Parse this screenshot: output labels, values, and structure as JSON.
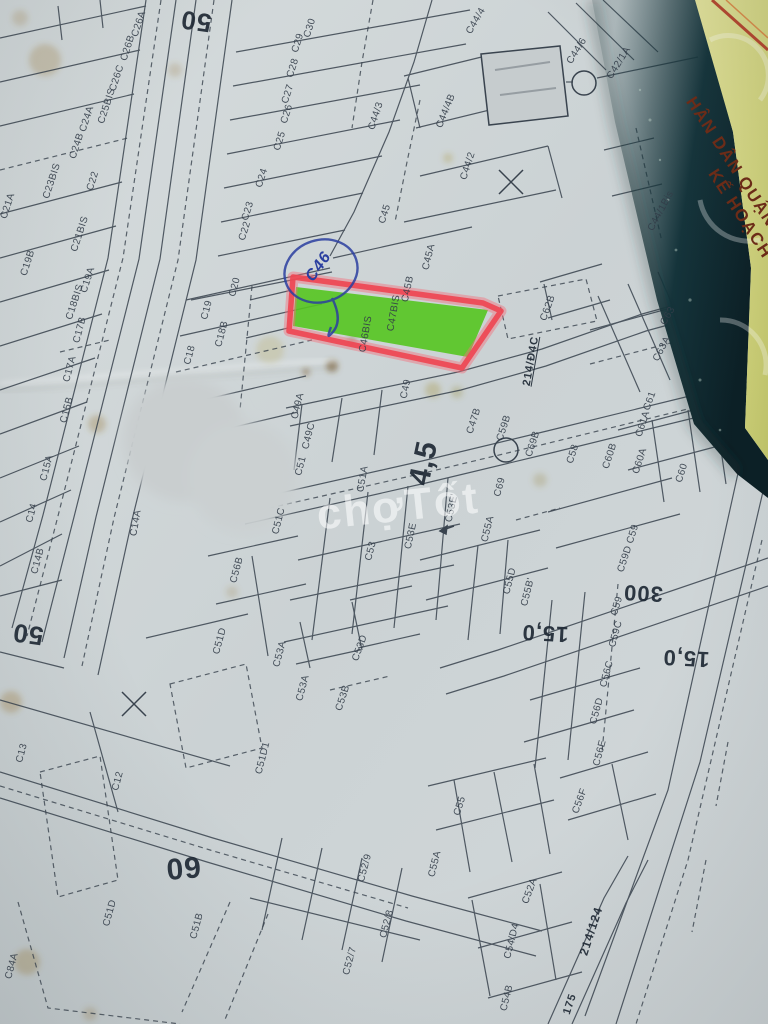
{
  "watermark": {
    "text": "chợTốt"
  },
  "cover_strip": {
    "line1": "HÂN DÂN QUẬN",
    "line2": "KẾ HOẠCH"
  },
  "annotations": {
    "handwritten_parcel": "C46"
  },
  "highlight": {
    "fill": "#55c520",
    "outline": "#ee4752",
    "pen": "#2b3fa0"
  },
  "parcel_labels": [
    {
      "t": "C26A",
      "x": 139,
      "y": 24,
      "r": -72
    },
    {
      "t": "C26B",
      "x": 128,
      "y": 48,
      "r": -72
    },
    {
      "t": "C26C",
      "x": 117,
      "y": 78,
      "r": -72
    },
    {
      "t": "C25BIS",
      "x": 107,
      "y": 106,
      "r": -72
    },
    {
      "t": "C24A",
      "x": 87,
      "y": 119,
      "r": -72
    },
    {
      "t": "C24B",
      "x": 77,
      "y": 146,
      "r": -72
    },
    {
      "t": "C23BIS",
      "x": 52,
      "y": 181,
      "r": -72
    },
    {
      "t": "C22",
      "x": 93,
      "y": 181,
      "r": -72
    },
    {
      "t": "C21A",
      "x": 8,
      "y": 206,
      "r": -72
    },
    {
      "t": "C21BIS",
      "x": 80,
      "y": 234,
      "r": -72
    },
    {
      "t": "C19B",
      "x": 28,
      "y": 263,
      "r": -72
    },
    {
      "t": "C19A",
      "x": 88,
      "y": 280,
      "r": -72
    },
    {
      "t": "C18BIS",
      "x": 75,
      "y": 302,
      "r": -72
    },
    {
      "t": "C17B",
      "x": 80,
      "y": 330,
      "r": -75
    },
    {
      "t": "C17A",
      "x": 70,
      "y": 369,
      "r": -75
    },
    {
      "t": "C15B",
      "x": 67,
      "y": 410,
      "r": -75
    },
    {
      "t": "C15A",
      "x": 47,
      "y": 468,
      "r": -75
    },
    {
      "t": "C14",
      "x": 32,
      "y": 513,
      "r": -75
    },
    {
      "t": "C14B",
      "x": 38,
      "y": 561,
      "r": -75
    },
    {
      "t": "C14A",
      "x": 136,
      "y": 523,
      "r": -80
    },
    {
      "t": "C30",
      "x": 310,
      "y": 28,
      "r": -72
    },
    {
      "t": "C29",
      "x": 298,
      "y": 43,
      "r": -72
    },
    {
      "t": "C28",
      "x": 293,
      "y": 68,
      "r": -72
    },
    {
      "t": "C27",
      "x": 288,
      "y": 94,
      "r": -72
    },
    {
      "t": "C26",
      "x": 287,
      "y": 114,
      "r": -72
    },
    {
      "t": "C25",
      "x": 280,
      "y": 141,
      "r": -72
    },
    {
      "t": "C24",
      "x": 262,
      "y": 178,
      "r": -72
    },
    {
      "t": "C23",
      "x": 248,
      "y": 211,
      "r": -72
    },
    {
      "t": "C22",
      "x": 245,
      "y": 231,
      "r": -72
    },
    {
      "t": "C20",
      "x": 235,
      "y": 287,
      "r": -75
    },
    {
      "t": "C19",
      "x": 207,
      "y": 310,
      "r": -75
    },
    {
      "t": "C18B",
      "x": 222,
      "y": 334,
      "r": -75
    },
    {
      "t": "C18",
      "x": 190,
      "y": 355,
      "r": -75
    },
    {
      "t": "C44/3",
      "x": 376,
      "y": 116,
      "r": -72
    },
    {
      "t": "C44/4",
      "x": 476,
      "y": 21,
      "r": -60
    },
    {
      "t": "C44/4B",
      "x": 446,
      "y": 111,
      "r": -68
    },
    {
      "t": "C44/2",
      "x": 468,
      "y": 166,
      "r": -72
    },
    {
      "t": "C44/6",
      "x": 577,
      "y": 51,
      "r": -58
    },
    {
      "t": "C42/1A",
      "x": 619,
      "y": 63,
      "r": -58
    },
    {
      "t": "C44/1Bis",
      "x": 661,
      "y": 211,
      "r": -62
    },
    {
      "t": "C45",
      "x": 385,
      "y": 214,
      "r": -72
    },
    {
      "t": "C45A",
      "x": 429,
      "y": 257,
      "r": -76
    },
    {
      "t": "C45B",
      "x": 408,
      "y": 289,
      "r": -78
    },
    {
      "t": "C47BIS",
      "x": 394,
      "y": 313,
      "r": -80
    },
    {
      "t": "C46BIS",
      "x": 366,
      "y": 334,
      "r": -80
    },
    {
      "t": "C49",
      "x": 406,
      "y": 389,
      "r": -78
    },
    {
      "t": "C49A",
      "x": 298,
      "y": 406,
      "r": -76
    },
    {
      "t": "C49C",
      "x": 309,
      "y": 436,
      "r": -76
    },
    {
      "t": "C51",
      "x": 301,
      "y": 466,
      "r": -76
    },
    {
      "t": "C51A",
      "x": 363,
      "y": 479,
      "r": -80
    },
    {
      "t": "C51C",
      "x": 279,
      "y": 521,
      "r": -76
    },
    {
      "t": "C47B",
      "x": 474,
      "y": 421,
      "r": -72
    },
    {
      "t": "C62B",
      "x": 548,
      "y": 308,
      "r": -70
    },
    {
      "t": "C63",
      "x": 668,
      "y": 316,
      "r": -60
    },
    {
      "t": "C63A",
      "x": 662,
      "y": 349,
      "r": -62
    },
    {
      "t": "C61",
      "x": 650,
      "y": 401,
      "r": -70
    },
    {
      "t": "C61A",
      "x": 643,
      "y": 424,
      "r": -72
    },
    {
      "t": "C59B",
      "x": 504,
      "y": 428,
      "r": -72
    },
    {
      "t": "C69B",
      "x": 533,
      "y": 444,
      "r": -72
    },
    {
      "t": "C58",
      "x": 573,
      "y": 454,
      "r": -72
    },
    {
      "t": "C60B",
      "x": 610,
      "y": 456,
      "r": -72
    },
    {
      "t": "C60A",
      "x": 640,
      "y": 461,
      "r": -72
    },
    {
      "t": "C60",
      "x": 682,
      "y": 473,
      "r": -72
    },
    {
      "t": "C69",
      "x": 500,
      "y": 487,
      "r": -75
    },
    {
      "t": "C59",
      "x": 633,
      "y": 534,
      "r": -72
    },
    {
      "t": "C59D",
      "x": 625,
      "y": 559,
      "r": -72
    },
    {
      "t": "C59",
      "x": 617,
      "y": 606,
      "r": -72
    },
    {
      "t": "C59C",
      "x": 616,
      "y": 634,
      "r": -75
    },
    {
      "t": "C55D",
      "x": 510,
      "y": 581,
      "r": -76
    },
    {
      "t": "C55B'",
      "x": 528,
      "y": 592,
      "r": -76
    },
    {
      "t": "C53E'",
      "x": 452,
      "y": 508,
      "r": -78
    },
    {
      "t": "C53E",
      "x": 411,
      "y": 536,
      "r": -78
    },
    {
      "t": "C53",
      "x": 371,
      "y": 551,
      "r": -76
    },
    {
      "t": "C55A",
      "x": 488,
      "y": 529,
      "r": -76
    },
    {
      "t": "C56B",
      "x": 237,
      "y": 570,
      "r": -75
    },
    {
      "t": "C51D",
      "x": 220,
      "y": 641,
      "r": -75
    },
    {
      "t": "C53A",
      "x": 280,
      "y": 654,
      "r": -75
    },
    {
      "t": "C53D",
      "x": 360,
      "y": 648,
      "r": -70
    },
    {
      "t": "C53A",
      "x": 303,
      "y": 688,
      "r": -75
    },
    {
      "t": "C53B",
      "x": 343,
      "y": 698,
      "r": -72
    },
    {
      "t": "C51D1",
      "x": 263,
      "y": 758,
      "r": -76
    },
    {
      "t": "C13",
      "x": 22,
      "y": 753,
      "r": -75
    },
    {
      "t": "C12",
      "x": 118,
      "y": 781,
      "r": -75
    },
    {
      "t": "C51D",
      "x": 110,
      "y": 913,
      "r": -75
    },
    {
      "t": "C51B",
      "x": 197,
      "y": 926,
      "r": -75
    },
    {
      "t": "C84A",
      "x": 12,
      "y": 966,
      "r": -75
    },
    {
      "t": "C52/7",
      "x": 350,
      "y": 961,
      "r": -75
    },
    {
      "t": "C52/8",
      "x": 387,
      "y": 924,
      "r": -75
    },
    {
      "t": "C52/9",
      "x": 365,
      "y": 868,
      "r": -75
    },
    {
      "t": "C55",
      "x": 460,
      "y": 806,
      "r": -72
    },
    {
      "t": "C55A",
      "x": 435,
      "y": 864,
      "r": -76
    },
    {
      "t": "C52A",
      "x": 530,
      "y": 891,
      "r": -70
    },
    {
      "t": "C54/D4",
      "x": 512,
      "y": 941,
      "r": -76
    },
    {
      "t": "C54B",
      "x": 507,
      "y": 998,
      "r": -76
    },
    {
      "t": "C56F",
      "x": 580,
      "y": 801,
      "r": -70
    },
    {
      "t": "C56C",
      "x": 607,
      "y": 674,
      "r": -75
    },
    {
      "t": "C56D",
      "x": 597,
      "y": 711,
      "r": -75
    },
    {
      "t": "C56E",
      "x": 600,
      "y": 753,
      "r": -75
    }
  ],
  "measure_labels": [
    {
      "t": "50",
      "x": 196,
      "y": 21,
      "r": 188,
      "s": 26
    },
    {
      "t": "50",
      "x": 28,
      "y": 634,
      "r": 188,
      "s": 26
    },
    {
      "t": "60",
      "x": 183,
      "y": 867,
      "r": 175,
      "s": 30
    },
    {
      "t": "4,5",
      "x": 424,
      "y": 463,
      "r": -78,
      "s": 30
    },
    {
      "t": "300",
      "x": 643,
      "y": 593,
      "r": 183,
      "s": 22
    },
    {
      "t": "15,0",
      "x": 545,
      "y": 633,
      "r": 183,
      "s": 22
    },
    {
      "t": "15,0",
      "x": 686,
      "y": 658,
      "r": 183,
      "s": 22
    },
    {
      "t": "214/Đ4C",
      "x": 531,
      "y": 361,
      "r": -80,
      "s": 11,
      "u": 1
    },
    {
      "t": "214/124",
      "x": 591,
      "y": 931,
      "r": -72,
      "s": 12
    },
    {
      "t": "175",
      "x": 570,
      "y": 1004,
      "r": -72,
      "s": 11
    }
  ]
}
